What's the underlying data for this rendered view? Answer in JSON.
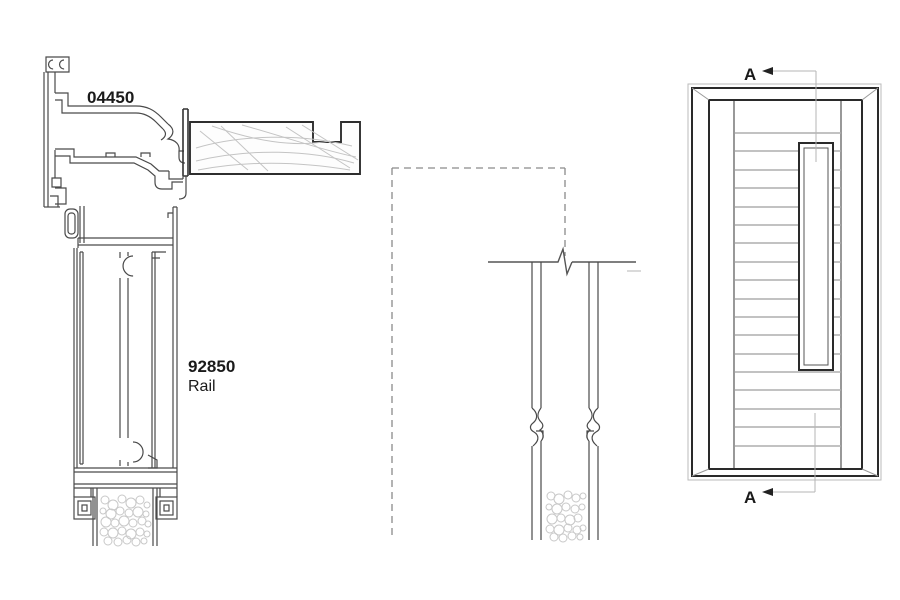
{
  "drawing": {
    "background_color": "#ffffff",
    "line_color": "#4a4a4a",
    "dark_line_color": "#2a2a2a",
    "hatch_color": "#c4c4c4",
    "plank_color": "#aeaeae",
    "dash_color": "#8a8a8a",
    "section_line_color": "#b5b5b5"
  },
  "head_detail": {
    "profile_number": "04450",
    "rail_number": "92850",
    "rail_name": "Rail"
  },
  "elevation": {
    "section_label_top": "A",
    "section_label_bottom": "A"
  }
}
